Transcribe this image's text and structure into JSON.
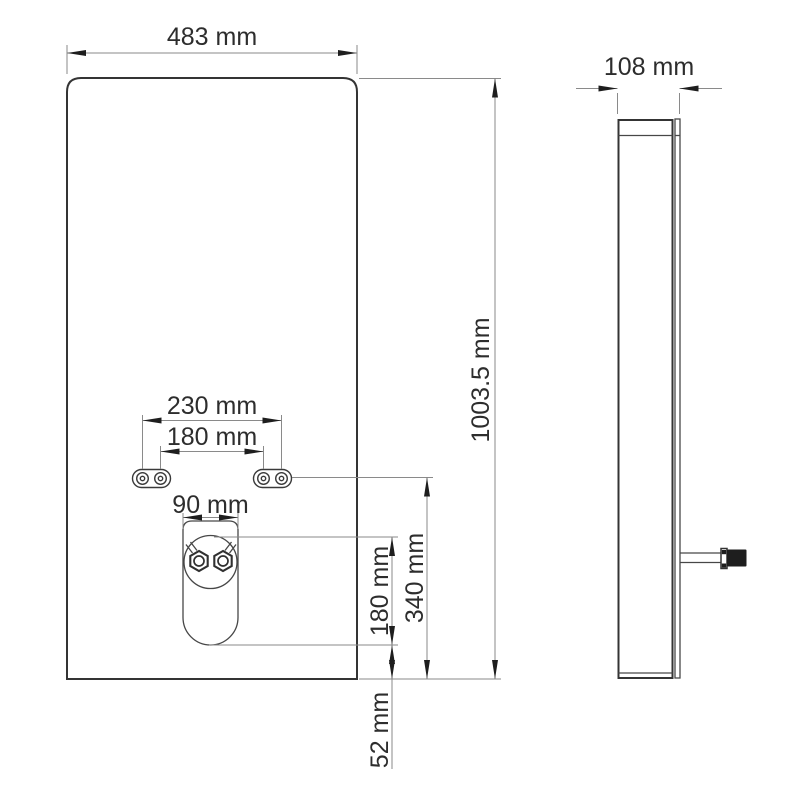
{
  "dimensions": {
    "front_width": "483 mm",
    "front_height": "1003.5 mm",
    "side_depth": "108 mm",
    "mount_holes_outer": "230 mm",
    "mount_holes_inner": "180 mm",
    "cutout_width": "90 mm",
    "cutout_height": "180 mm",
    "mount_holes_to_bottom": "340 mm",
    "cutout_bottom_gap": "52 mm"
  },
  "colors": {
    "background": "#ffffff",
    "geometry_line": "#3a3a3a",
    "dimension_line": "#8a8a8a",
    "arrow": "#1e1e1e",
    "text": "#2d2d2d"
  }
}
